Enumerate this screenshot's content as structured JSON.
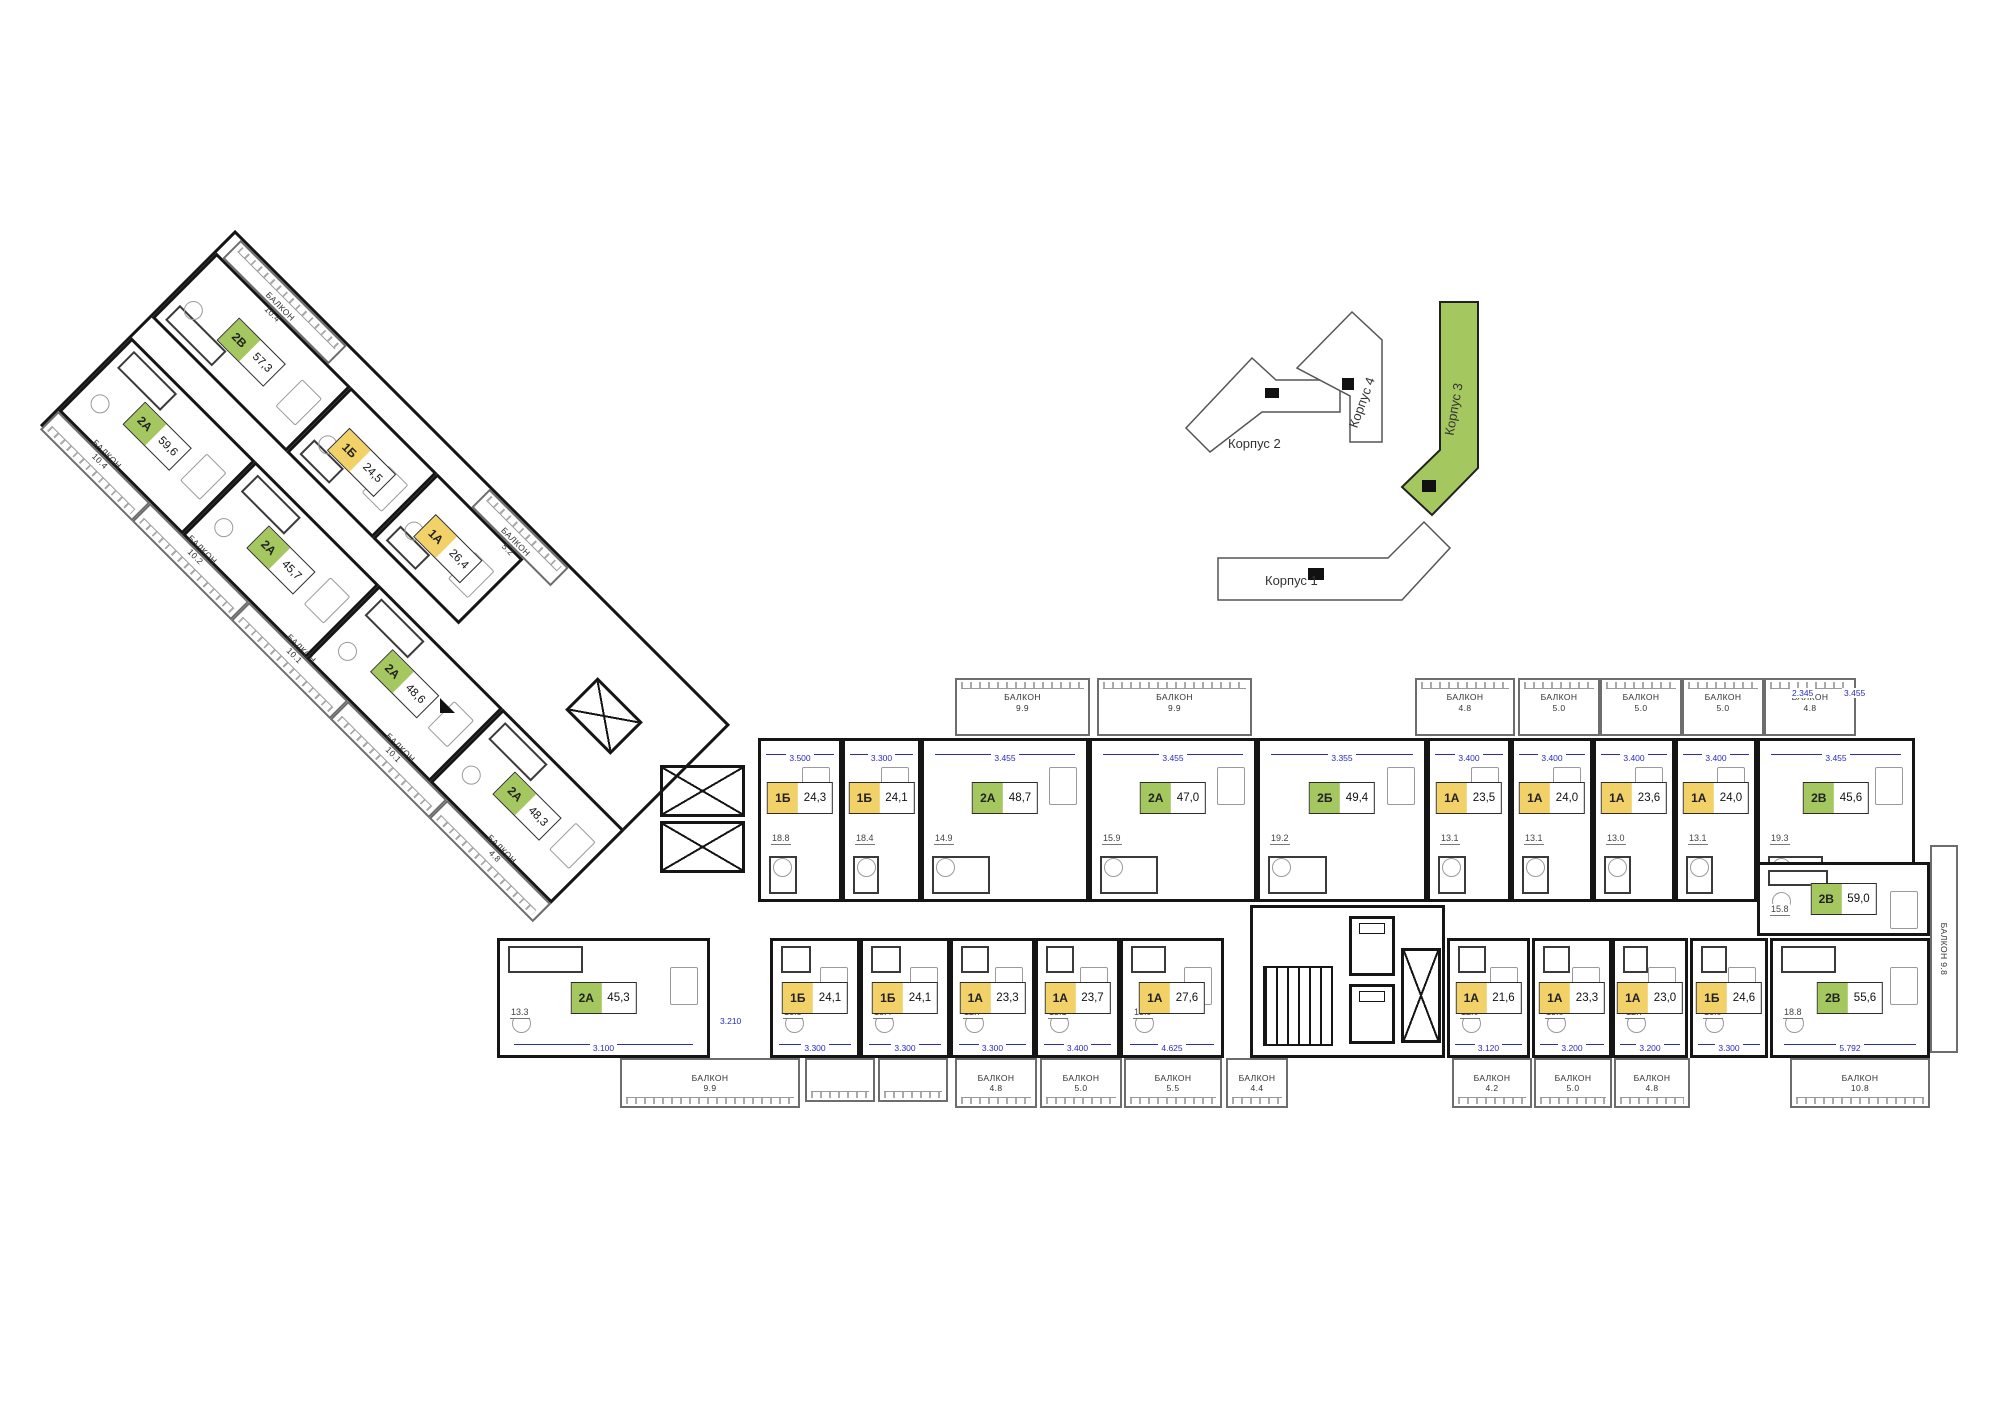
{
  "colors": {
    "one_room": "#f2d169",
    "two_room": "#a5c75f",
    "dimension": "#2a2ac0",
    "wall": "#151515",
    "active_building": "#a5c75f"
  },
  "site_plan": {
    "buildings": [
      {
        "label": "Корпус 2",
        "active": false
      },
      {
        "label": "Корпус 4",
        "active": false
      },
      {
        "label": "Корпус 3",
        "active": true
      },
      {
        "label": "Корпус 1",
        "active": false
      }
    ]
  },
  "wing_diagonal": {
    "top_balconies": [
      {
        "label": "БАЛКОН",
        "value": "10.4"
      },
      {
        "label": "БАЛКОН",
        "value": "5.2"
      }
    ],
    "top_units": [
      {
        "code": "2В",
        "area": "57,3",
        "cat": "two"
      },
      {
        "code": "1Б",
        "area": "24,5",
        "cat": "one"
      },
      {
        "code": "1А",
        "area": "26,4",
        "cat": "one"
      }
    ],
    "bottom_units": [
      {
        "code": "2А",
        "area": "59,6",
        "cat": "two"
      },
      {
        "code": "2А",
        "area": "45,7",
        "cat": "two"
      },
      {
        "code": "2А",
        "area": "48,6",
        "cat": "two"
      },
      {
        "code": "2А",
        "area": "48,3",
        "cat": "two"
      }
    ],
    "bottom_balconies": [
      {
        "label": "БАЛКОН",
        "value": "10.4"
      },
      {
        "label": "БАЛКОН",
        "value": "10.2"
      },
      {
        "label": "БАЛКОН",
        "value": "10.1"
      },
      {
        "label": "БАЛКОН",
        "value": "10.1"
      },
      {
        "label": "БАЛКОН",
        "value": "4.8"
      }
    ]
  },
  "wing_main": {
    "top_balconies": [
      {
        "label": "БАЛКОН",
        "value": "9.9"
      },
      {
        "label": "БАЛКОН",
        "value": "9.9"
      },
      {
        "label": "БАЛКОН",
        "value": "4.8"
      },
      {
        "label": "БАЛКОН",
        "value": "5.0"
      },
      {
        "label": "БАЛКОН",
        "value": "5.0"
      },
      {
        "label": "БАЛКОН",
        "value": "5.0"
      },
      {
        "label": "БАЛКОН",
        "value": "4.8"
      }
    ],
    "top_units": [
      {
        "code": "1Б",
        "area": "24,3",
        "cat": "one",
        "dim": "3.500",
        "room": "18.8"
      },
      {
        "code": "1Б",
        "area": "24,1",
        "cat": "one",
        "dim": "3.300",
        "room": "18.4"
      },
      {
        "code": "2А",
        "area": "48,7",
        "cat": "two",
        "dim": "3.455",
        "room": "14.9"
      },
      {
        "code": "2А",
        "area": "47,0",
        "cat": "two",
        "dim": "3.455",
        "room": "15.9"
      },
      {
        "code": "2Б",
        "area": "49,4",
        "cat": "two",
        "dim": "3.355",
        "room": "19.2"
      },
      {
        "code": "1А",
        "area": "23,5",
        "cat": "one",
        "dim": "3.400",
        "room": "13.1"
      },
      {
        "code": "1А",
        "area": "24,0",
        "cat": "one",
        "dim": "3.400",
        "room": "13.1"
      },
      {
        "code": "1А",
        "area": "23,6",
        "cat": "one",
        "dim": "3.400",
        "room": "13.0"
      },
      {
        "code": "1А",
        "area": "24,0",
        "cat": "one",
        "dim": "3.400",
        "room": "13.1"
      },
      {
        "code": "2В",
        "area": "45,6",
        "cat": "two",
        "dim": "3.455",
        "room": "19.3"
      }
    ],
    "bottom_units": [
      {
        "code": "2А",
        "area": "45,3",
        "cat": "two",
        "dim": "3.100",
        "room": "13.3"
      },
      {
        "code": "1Б",
        "area": "24,1",
        "cat": "one",
        "dim": "3.300",
        "room": "18.8"
      },
      {
        "code": "1Б",
        "area": "24,1",
        "cat": "one",
        "dim": "3.300",
        "room": "18.4"
      },
      {
        "code": "1А",
        "area": "23,3",
        "cat": "one",
        "dim": "3.300",
        "room": "12.7"
      },
      {
        "code": "1А",
        "area": "23,7",
        "cat": "one",
        "dim": "3.400",
        "room": "13.1"
      },
      {
        "code": "1А",
        "area": "27,6",
        "cat": "one",
        "dim": "4.625",
        "room": "13.9"
      },
      {
        "code": "1А",
        "area": "21,6",
        "cat": "one",
        "dim": "3.120",
        "room": "12.0"
      },
      {
        "code": "1А",
        "area": "23,3",
        "cat": "one",
        "dim": "3.200",
        "room": "13.0"
      },
      {
        "code": "1А",
        "area": "23,0",
        "cat": "one",
        "dim": "3.200",
        "room": "12.7"
      },
      {
        "code": "1Б",
        "area": "24,6",
        "cat": "one",
        "dim": "3.300",
        "room": "18.0"
      },
      {
        "code": "2В",
        "area": "55,6",
        "cat": "two",
        "dim": "5.792",
        "room": "18.8"
      }
    ],
    "bottom_balconies": [
      {
        "label": "БАЛКОН",
        "value": "9.9"
      },
      {
        "label": "БАЛКОН",
        "value": "4.8"
      },
      {
        "label": "БАЛКОН",
        "value": "5.0"
      },
      {
        "label": "БАЛКОН",
        "value": "5.5"
      },
      {
        "label": "БАЛКОН",
        "value": "4.4"
      },
      {
        "label": "БАЛКОН",
        "value": "4.2"
      },
      {
        "label": "БАЛКОН",
        "value": "5.0"
      },
      {
        "label": "БАЛКОН",
        "value": "4.8"
      },
      {
        "label": "БАЛКОН",
        "value": "10.8"
      }
    ],
    "right_unit": {
      "code": "2В",
      "area": "59,0",
      "cat": "two",
      "room": "15.8"
    },
    "right_edge_balcony": {
      "label": "БАЛКОН",
      "value": "9.8"
    },
    "floating_dims": [
      "2.345",
      "3.455",
      "3.210"
    ]
  }
}
